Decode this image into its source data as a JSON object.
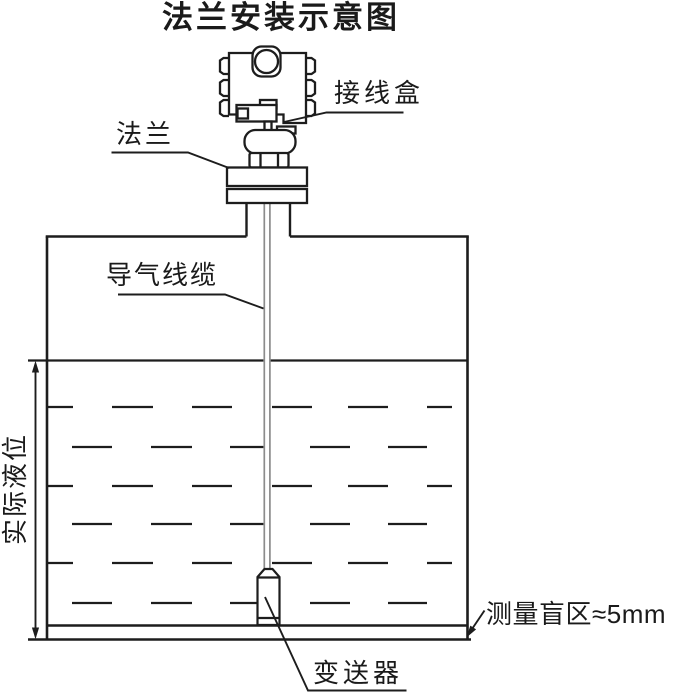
{
  "title": "法兰安装示意图",
  "labels": {
    "junction_box": "接线盒",
    "flange": "法兰",
    "vent_cable": "导气线缆",
    "actual_level": "实际液位",
    "blind_zone": "测量盲区≈5mm",
    "transmitter": "变送器"
  },
  "colors": {
    "line": "#1d1d1d",
    "cable": "#8c8c8c",
    "text": "#1a1a1a",
    "background": "#ffffff"
  }
}
